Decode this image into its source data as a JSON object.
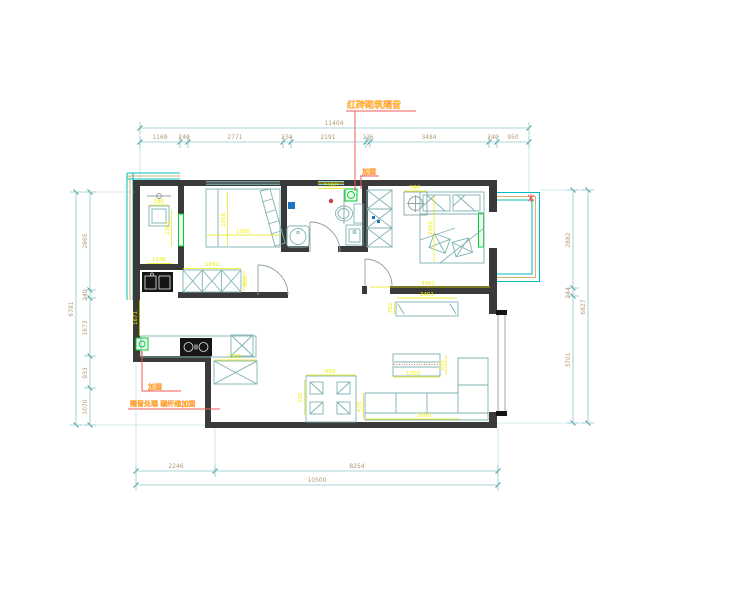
{
  "document": {
    "type": "apartment floor plan (CAD drawing)",
    "background": "#ffffff"
  },
  "colors": {
    "walls": "#3a3a3a",
    "dimension_lines": "#8fc6c6",
    "dimension_text": "#b39a72",
    "interior_dimension_text": "#f0f000",
    "callout_text": "#ffdd00",
    "callout_leader": "#f05a5a",
    "window_glass": "#00bcbc",
    "window_frame": "#d9b273",
    "highlight_green": "#00cc33",
    "fixture_black": "#151515"
  },
  "dimensions": {
    "top": {
      "total": "11404",
      "segments": [
        "1169",
        "240",
        "2771",
        "234",
        "2191",
        "125",
        "3484",
        "240",
        "950"
      ]
    },
    "bottom": {
      "total": "10500",
      "segments": [
        "2246",
        "8254"
      ]
    },
    "left": {
      "total": "6781",
      "segments": [
        "2865",
        "240",
        "1673",
        "933",
        "1070"
      ]
    },
    "right": {
      "total": "6827",
      "segments": [
        "2882",
        "244",
        "3701"
      ]
    }
  },
  "callouts": [
    {
      "text": "红砖砌筑隔音",
      "meaning": "red-brick masonry sound insulation"
    },
    {
      "text": "加固",
      "meaning": "reinforcement (top bathroom washer)"
    },
    {
      "text": "加固",
      "meaning": "reinforcement (kitchen left wall)"
    },
    {
      "text": "隔音处理 碳纤维加固",
      "meaning": "sound-insulation treatment, reinforcement"
    }
  ],
  "texts": [
    {
      "n": "dim-top-total",
      "t": "11404",
      "x": 334,
      "y": 125,
      "c": "dim"
    },
    {
      "n": "dim-top-1",
      "t": "1169",
      "x": 160,
      "y": 139,
      "c": "dim"
    },
    {
      "n": "dim-top-2",
      "t": "240",
      "x": 184,
      "y": 139,
      "c": "dim"
    },
    {
      "n": "dim-top-3",
      "t": "2771",
      "x": 235,
      "y": 139,
      "c": "dim"
    },
    {
      "n": "dim-top-4",
      "t": "234",
      "x": 287,
      "y": 139,
      "c": "dim"
    },
    {
      "n": "dim-top-5",
      "t": "2191",
      "x": 328,
      "y": 139,
      "c": "dim"
    },
    {
      "n": "dim-top-6",
      "t": "125",
      "x": 368,
      "y": 139,
      "c": "dim"
    },
    {
      "n": "dim-top-7",
      "t": "3484",
      "x": 429,
      "y": 139,
      "c": "dim"
    },
    {
      "n": "dim-top-8",
      "t": "240",
      "x": 493,
      "y": 139,
      "c": "dim"
    },
    {
      "n": "dim-top-9",
      "t": "950",
      "x": 513,
      "y": 139,
      "c": "dim"
    },
    {
      "n": "dim-bottom-1",
      "t": "2246",
      "x": 176,
      "y": 468,
      "c": "dim"
    },
    {
      "n": "dim-bottom-2",
      "t": "8254",
      "x": 357,
      "y": 468,
      "c": "dim"
    },
    {
      "n": "dim-bottom-total",
      "t": "10500",
      "x": 317,
      "y": 482,
      "c": "dim"
    },
    {
      "n": "dim-left-1",
      "t": "2865",
      "x": 87,
      "y": 241,
      "c": "dim",
      "r": -90
    },
    {
      "n": "dim-left-2",
      "t": "240",
      "x": 87,
      "y": 295,
      "c": "dim",
      "r": -90
    },
    {
      "n": "dim-left-3",
      "t": "1673",
      "x": 87,
      "y": 328,
      "c": "dim",
      "r": -90
    },
    {
      "n": "dim-left-4",
      "t": "933",
      "x": 87,
      "y": 373,
      "c": "dim",
      "r": -90
    },
    {
      "n": "dim-left-5",
      "t": "1070",
      "x": 87,
      "y": 407,
      "c": "dim",
      "r": -90
    },
    {
      "n": "dim-left-total",
      "t": "6781",
      "x": 73,
      "y": 309,
      "c": "dim",
      "r": -90
    },
    {
      "n": "dim-right-1",
      "t": "2882",
      "x": 570,
      "y": 240,
      "c": "dim",
      "r": -90
    },
    {
      "n": "dim-right-2",
      "t": "244",
      "x": 570,
      "y": 293,
      "c": "dim",
      "r": -90
    },
    {
      "n": "dim-right-3",
      "t": "3701",
      "x": 570,
      "y": 360,
      "c": "dim",
      "r": -90
    },
    {
      "n": "dim-right-total",
      "t": "6827",
      "x": 585,
      "y": 307,
      "c": "dim",
      "r": -90
    },
    {
      "n": "dim-room1-box",
      "t": "580",
      "x": 159,
      "y": 203,
      "c": "dimy"
    },
    {
      "n": "dim-room1-v",
      "t": "1362",
      "x": 169,
      "y": 228,
      "c": "dimy",
      "r": -90
    },
    {
      "n": "dim-room1-b",
      "t": "1146",
      "x": 159,
      "y": 261,
      "c": "dimy"
    },
    {
      "n": "dim-bed1-v",
      "t": "1506",
      "x": 225,
      "y": 220,
      "c": "dimy",
      "r": -90
    },
    {
      "n": "dim-bed1-h",
      "t": "2006",
      "x": 243,
      "y": 233,
      "c": "dimy"
    },
    {
      "n": "dim-ward1",
      "t": "1452",
      "x": 212,
      "y": 266,
      "c": "dimy"
    },
    {
      "n": "dim-ward1-d",
      "t": "600",
      "x": 247,
      "y": 281,
      "c": "dimy",
      "r": -90
    },
    {
      "n": "dim-bath-top",
      "t": "1160",
      "x": 331,
      "y": 187,
      "c": "dimy"
    },
    {
      "n": "dim-bed2-ac",
      "t": "590",
      "x": 415,
      "y": 189,
      "c": "dimy"
    },
    {
      "n": "dim-bed2-v",
      "t": "2050",
      "x": 432,
      "y": 228,
      "c": "dimy",
      "r": -90
    },
    {
      "n": "dim-bed2-b",
      "t": "3401",
      "x": 428,
      "y": 285,
      "c": "dimy"
    },
    {
      "n": "dim-fridge",
      "t": "1100",
      "x": 234,
      "y": 358,
      "c": "dimy"
    },
    {
      "n": "dim-dining-w",
      "t": "800",
      "x": 330,
      "y": 373,
      "c": "dimy"
    },
    {
      "n": "dim-dining-h",
      "t": "720",
      "x": 302,
      "y": 398,
      "c": "dimy",
      "r": -90
    },
    {
      "n": "dim-tv",
      "t": "2401",
      "x": 427,
      "y": 296,
      "c": "dimy"
    },
    {
      "n": "dim-tv-d",
      "t": "352",
      "x": 392,
      "y": 308,
      "c": "dimy",
      "r": -90
    },
    {
      "n": "dim-ctable-w",
      "t": "1350",
      "x": 413,
      "y": 375,
      "c": "dimy"
    },
    {
      "n": "dim-ctable-h",
      "t": "691",
      "x": 444,
      "y": 365,
      "c": "dimy",
      "r": -90
    },
    {
      "n": "dim-sofa-w",
      "t": "2600",
      "x": 424,
      "y": 417,
      "c": "dimy"
    },
    {
      "n": "dim-sofa-d",
      "t": "470",
      "x": 361,
      "y": 407,
      "c": "dimy",
      "r": -90
    },
    {
      "n": "dim-kitchen-v",
      "t": "1671",
      "x": 137,
      "y": 318,
      "c": "dimy",
      "r": -90
    },
    {
      "n": "callout-brick",
      "t": "红砖砌筑隔音",
      "x": 347,
      "y": 108,
      "c": "callout",
      "s": 9
    },
    {
      "n": "callout-jiagu-top",
      "t": "加固",
      "x": 362,
      "y": 174,
      "c": "callout",
      "s": 7
    },
    {
      "n": "callout-jiagu-left",
      "t": "加固",
      "x": 148,
      "y": 389,
      "c": "callout",
      "s": 7
    },
    {
      "n": "callout-insulation",
      "t": "隔音处理 碳纤维加固",
      "x": 130,
      "y": 406,
      "c": "callout",
      "s": 7
    }
  ],
  "chains": {
    "top_segment_ticks_x": [
      140,
      180,
      188,
      283,
      291,
      366,
      370,
      489,
      497,
      529
    ],
    "top_total_ticks_x": [
      140,
      529
    ],
    "bottom_segment_ticks_x": [
      136,
      215,
      498
    ],
    "bottom_total_ticks_x": [
      136,
      498
    ],
    "left_segment_ticks_y": [
      192,
      290,
      298,
      356,
      388,
      425
    ],
    "left_total_ticks_y": [
      192,
      425
    ],
    "right_segment_ticks_y": [
      190,
      288,
      296,
      423
    ],
    "right_total_ticks_y": [
      190,
      423
    ]
  }
}
